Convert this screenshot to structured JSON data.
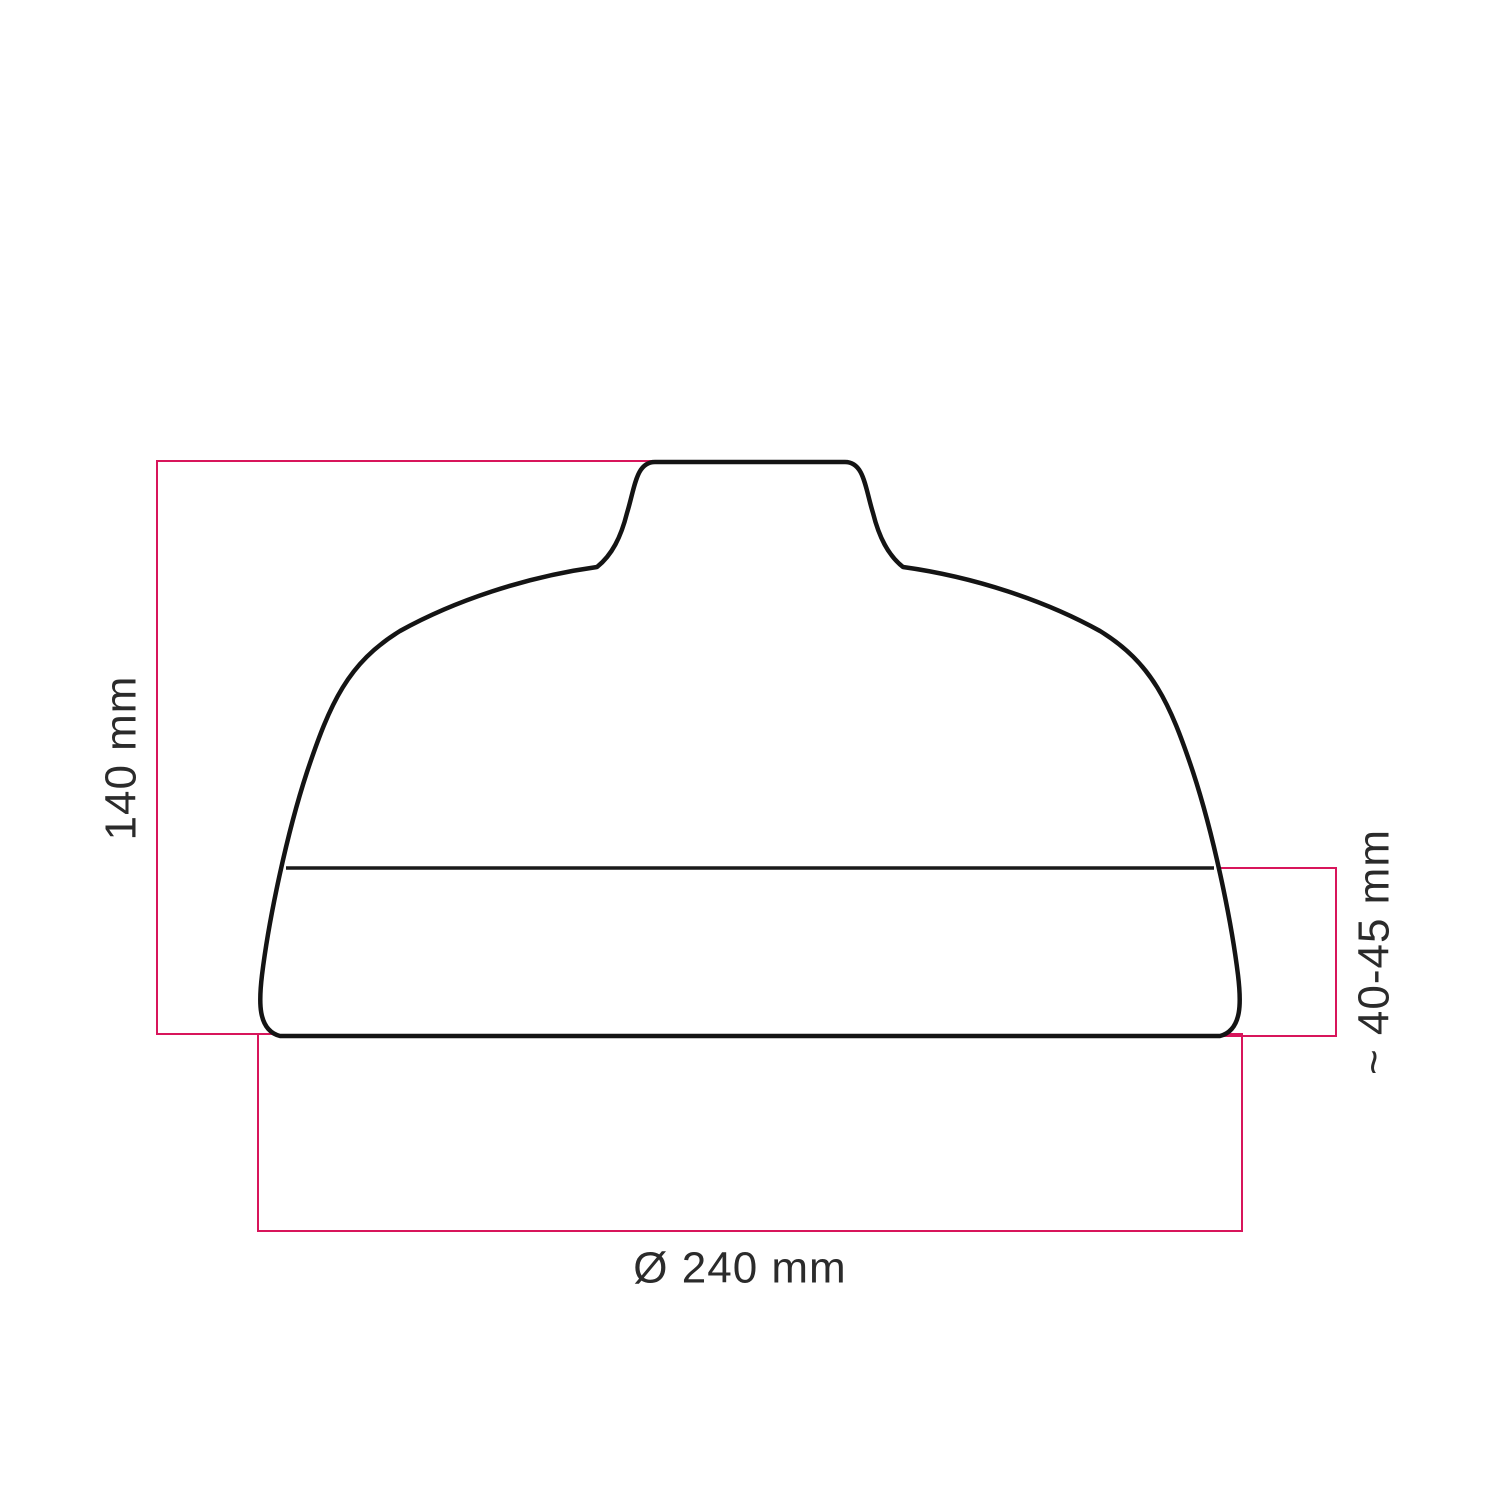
{
  "title": "Lampshade technical dimension drawing",
  "dimensions": {
    "height_label": "140 mm",
    "band_label": "~ 40-45 mm",
    "diameter_label": "Ø 240 mm"
  },
  "colors": {
    "dimension_line": "#d8155b",
    "outline": "#141414",
    "seam": "#1a1a1a",
    "label_text": "#2b2b2b",
    "background": "#ffffff",
    "shade_fill": "#ffffff"
  }
}
